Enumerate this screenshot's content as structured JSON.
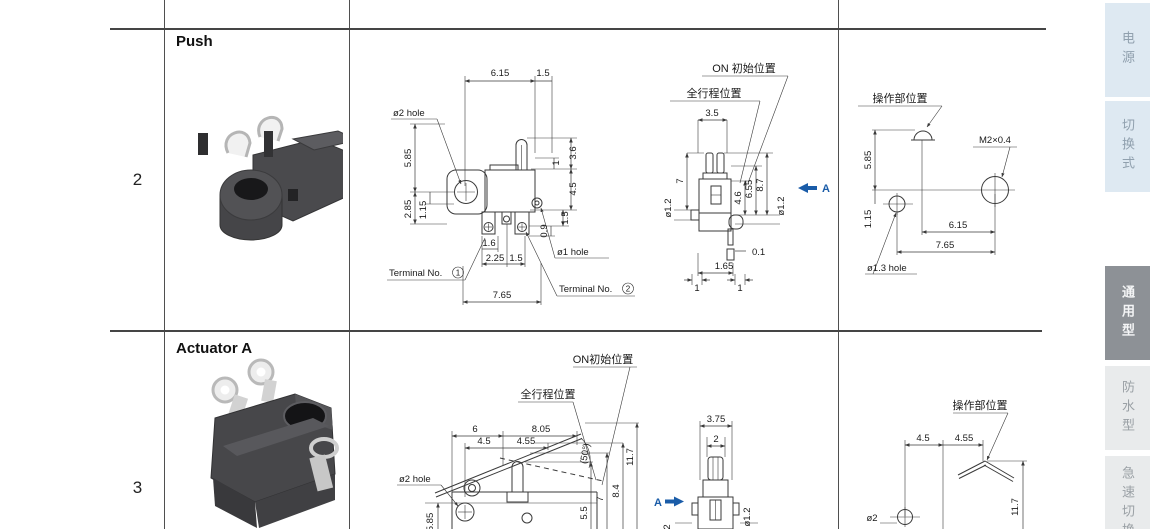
{
  "rows": [
    {
      "number": "2",
      "label": "Push"
    },
    {
      "number": "3",
      "label": "Actuator A"
    }
  ],
  "r2front": {
    "d615": "6.15",
    "d15top": "1.5",
    "hole2": "ø2 hole",
    "d585": "5.85",
    "d285": "2.85",
    "d115": "1.15",
    "d36": "3.6",
    "d1": "1",
    "d45": "4.5",
    "d15r": "1.5",
    "d09": "0.9",
    "d16": "1.6",
    "d225": "2.25",
    "d15b": "1.5",
    "d765": "7.65",
    "hole1": "ø1 hole",
    "term1": "Terminal No.",
    "t1": "1",
    "term2": "Terminal No.",
    "t2": "2"
  },
  "r2side": {
    "on": "ON 初始位置",
    "full": "全行程位置",
    "d35": "3.5",
    "d7": "7",
    "dia12l": "ø1.2",
    "d46": "4.6",
    "d655": "6.55",
    "d87": "8.7",
    "dia12r": "ø1.2",
    "a": "A",
    "d01": "0.1",
    "d165": "1.65",
    "d1l": "1",
    "d1r": "1"
  },
  "r2mount": {
    "op": "操作部位置",
    "thread": "M2×0.4",
    "d585": "5.85",
    "d115": "1.15",
    "d615": "6.15",
    "d765": "7.65",
    "hole13": "ø1.3 hole"
  },
  "r3front": {
    "on": "ON初始位置",
    "full": "全行程位置",
    "d6": "6",
    "d805": "8.05",
    "d45": "4.5",
    "d455": "4.55",
    "angle": "(50°)",
    "hole2": "ø2 hole",
    "d55": "5.5",
    "d7": "7",
    "d84": "8.4",
    "d117": "11.7",
    "d585": "5.85"
  },
  "r3side": {
    "d375": "3.75",
    "d2": "2",
    "a": "A",
    "dia12": "ø1.2",
    "d2b": "2"
  },
  "r3mount": {
    "op": "操作部位置",
    "d45": "4.5",
    "d455": "4.55",
    "d117": "11.7",
    "partial": "ø2"
  },
  "sidebar": {
    "tabs": [
      {
        "label": "电源"
      },
      {
        "label": "切换式"
      },
      {
        "label": "通用型"
      },
      {
        "label": "防水型"
      },
      {
        "label": "急速切换"
      }
    ]
  }
}
